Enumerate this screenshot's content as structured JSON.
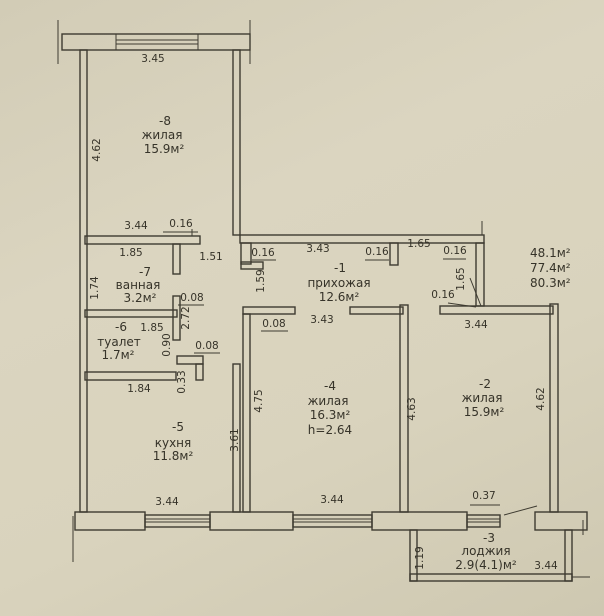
{
  "plan": {
    "rooms": {
      "r8": {
        "num": "-8",
        "name": "жилая",
        "area": "15.9м²"
      },
      "r7": {
        "num": "-7",
        "name": "ванная",
        "area": "3.2м²"
      },
      "r6": {
        "num": "-6",
        "name": "туалет",
        "area": "1.7м²"
      },
      "r5": {
        "num": "-5",
        "name": "кухня",
        "area": "11.8м²"
      },
      "r1": {
        "num": "-1",
        "name": "прихожая",
        "area": "12.6м²"
      },
      "r4": {
        "num": "-4",
        "name": "жилая",
        "area": "16.3м²",
        "ceiling": "h=2.64"
      },
      "r2": {
        "num": "-2",
        "name": "жилая",
        "area": "15.9м²"
      },
      "r3": {
        "num": "-3",
        "name": "лоджия",
        "area": "2.9(4.1)м²"
      }
    },
    "totals": {
      "line1": "48.1м²",
      "line2": "77.4м²",
      "line3": "80.3м²"
    },
    "dims": {
      "d008": "0.08",
      "d016": "0.16",
      "d033": "0.33",
      "d037": "0.37",
      "d090": "0.90",
      "d119": "1.19",
      "d151": "1.51",
      "d159": "1.59",
      "d165": "1.65",
      "d174": "1.74",
      "d184": "1.84",
      "d185": "1.85",
      "d272": "2.72",
      "d343": "3.43",
      "d344": "3.44",
      "d345": "3.45",
      "d361": "3.61",
      "d462": "4.62",
      "d463": "4.63",
      "d475": "4.75"
    }
  }
}
